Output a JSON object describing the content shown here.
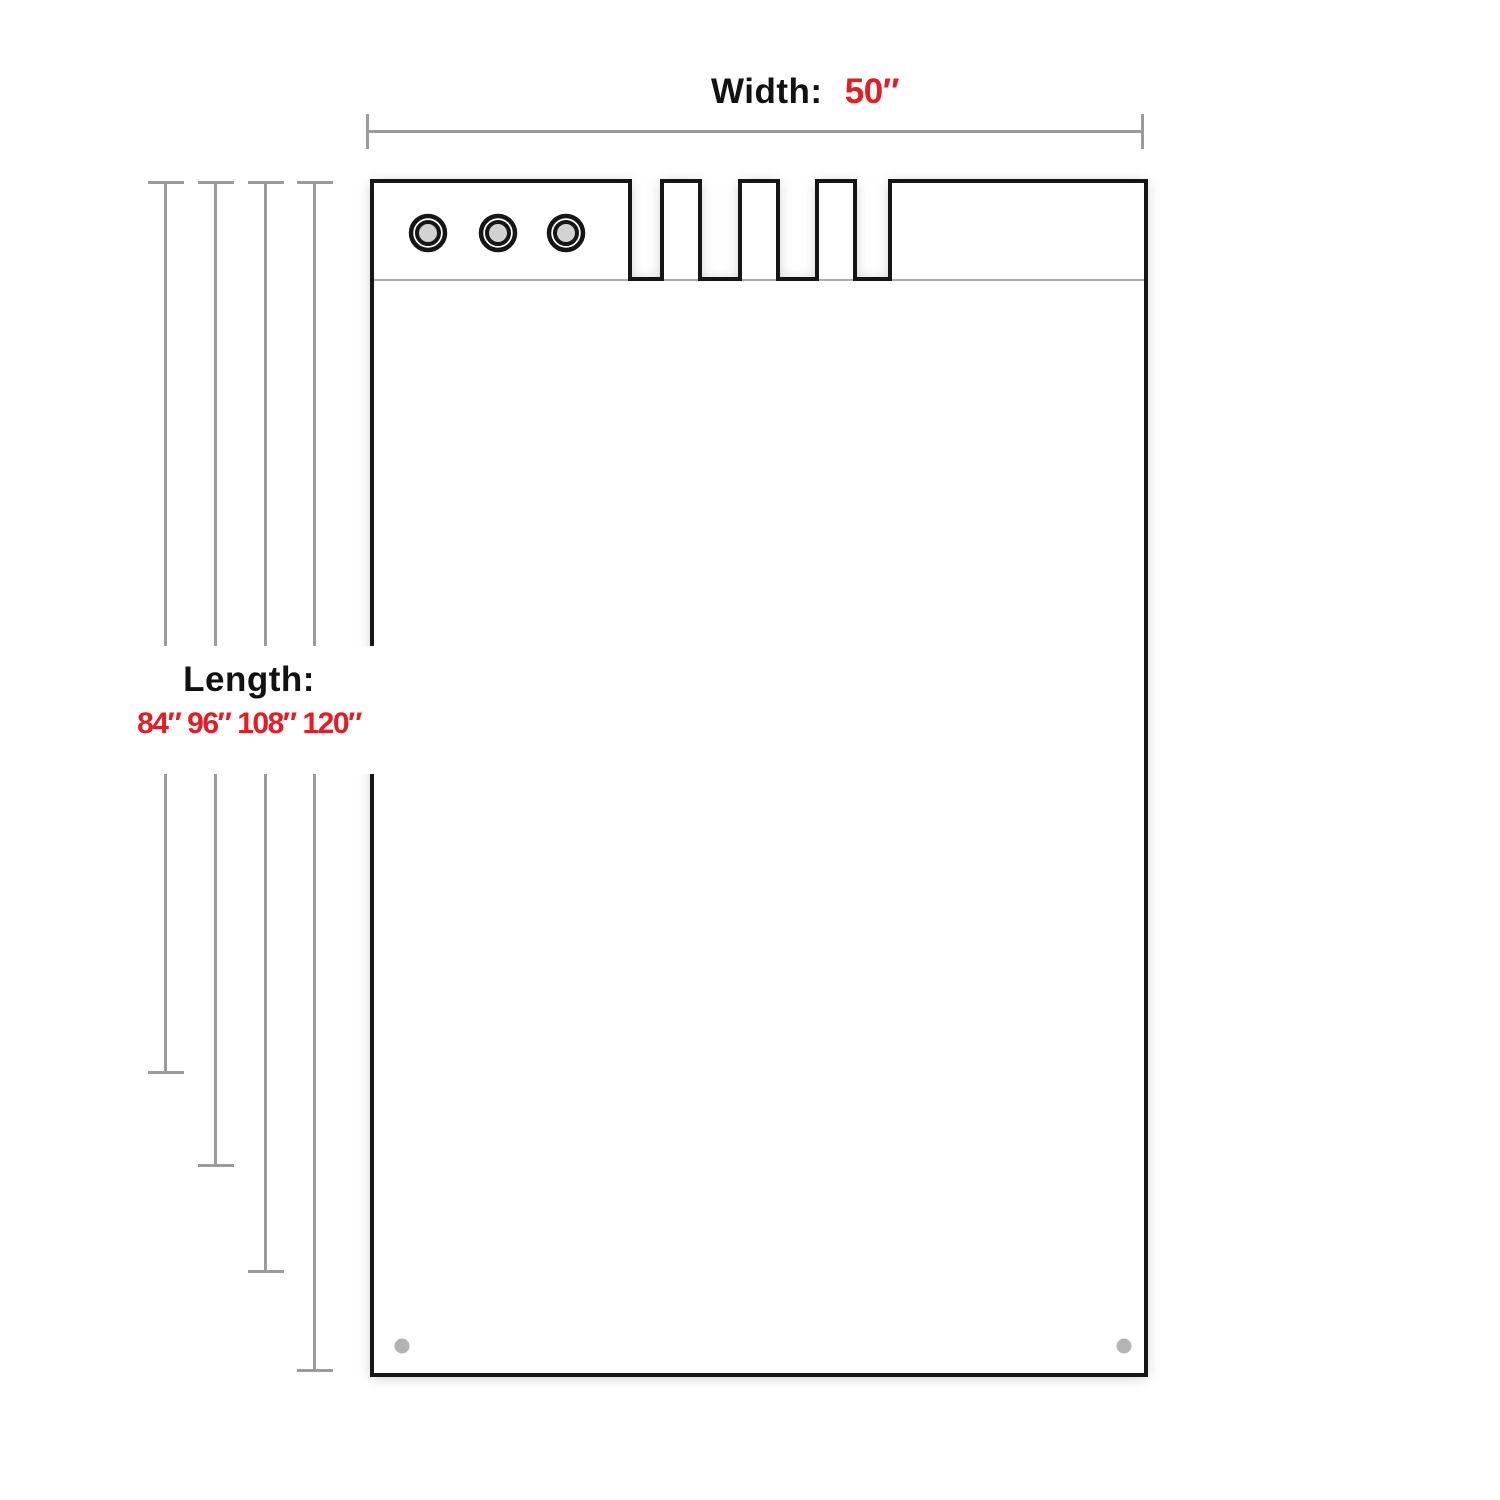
{
  "labels": {
    "width": {
      "label": "Width:",
      "value": "50″"
    },
    "length": {
      "label": "Length:",
      "values_text": "84″ 96″ 108″ 120″",
      "values": [
        "84″",
        "96″",
        "108″",
        "120″"
      ]
    }
  },
  "colors": {
    "accent_red": "#e41c23",
    "dimension_gray": "#9b9b9b",
    "outline_black": "#161616",
    "perforation_gray": "#909090",
    "grommet_center_gray": "#d2d2d2",
    "corner_hole_gray": "#b4b4b4"
  }
}
